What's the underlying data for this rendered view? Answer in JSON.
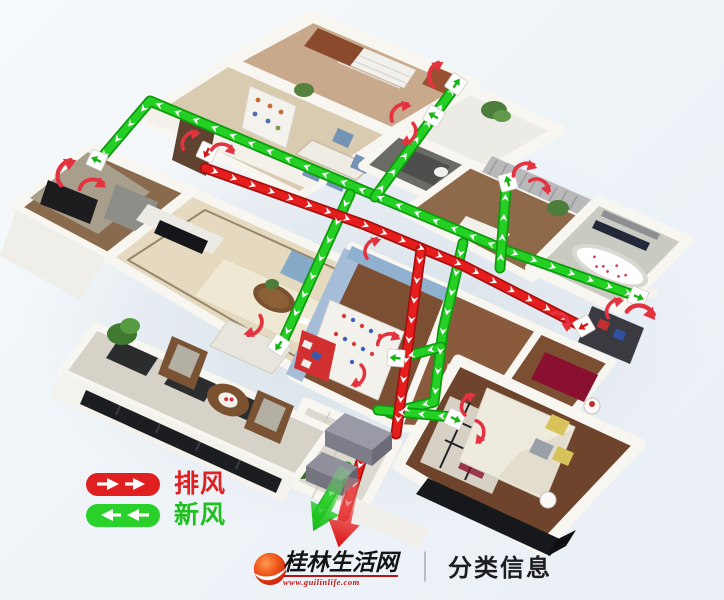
{
  "legend": {
    "items": [
      {
        "id": "exhaust-air",
        "label": "排风",
        "color": "#e02020",
        "arrow_direction": "right"
      },
      {
        "id": "fresh-air",
        "label": "新风",
        "color": "#2ad12a",
        "arrow_direction": "left"
      }
    ]
  },
  "watermark": {
    "site_name": "桂林生活网",
    "site_url": "www.guilinlife.com",
    "divider": "｜",
    "section": "分类信息",
    "logo_color": "#e04018"
  },
  "diagram": {
    "fresh_air_duct_color": "#24d024",
    "exhaust_air_duct_color": "#e51d1d",
    "duct_arrow_color": "#ffffff",
    "room_airflow_arrow_color": "#e43340"
  }
}
